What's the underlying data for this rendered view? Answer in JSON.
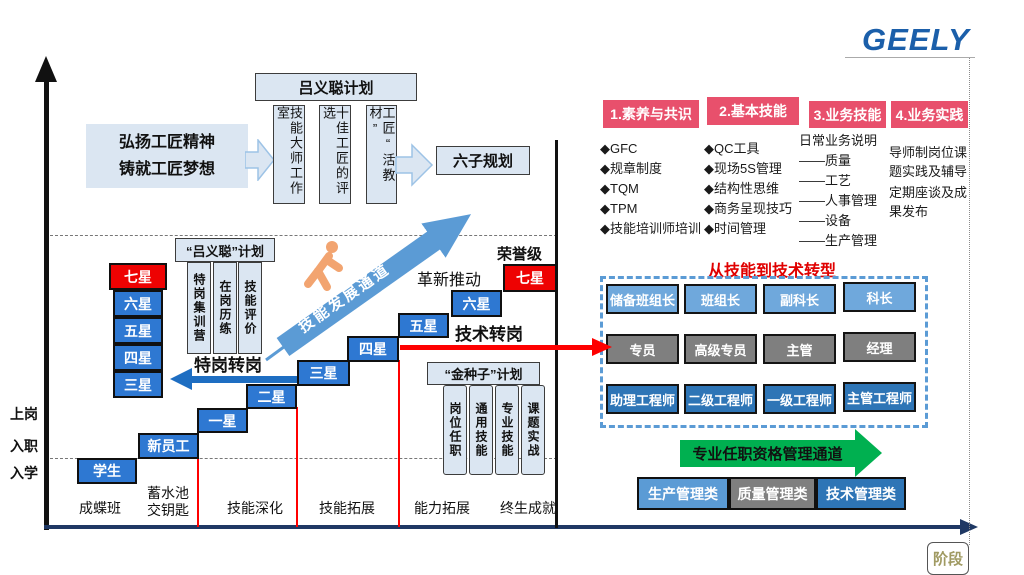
{
  "logo": {
    "text": "GEELY",
    "color": "#1b5faa"
  },
  "mission": {
    "line1": "弘扬工匠精神",
    "line2": "铸就工匠梦想"
  },
  "lvc_plan": {
    "title": "吕义聪计划",
    "columns": [
      "技能大师工作室",
      "十佳工匠的评选",
      "工匠“活教材”"
    ]
  },
  "six_plan": "六子规划",
  "quoted_plan": {
    "title": "“吕义聪”计划",
    "columns": [
      "特岗集训营",
      "在岗历练",
      "技能评价"
    ]
  },
  "gold_seed": {
    "title": "“金种子”计划",
    "columns": [
      "岗位任职",
      "通用技能",
      "专业技能",
      "课题实战"
    ]
  },
  "left_stars": {
    "top": "七星",
    "items": [
      "六星",
      "五星",
      "四星",
      "三星"
    ]
  },
  "staircase": [
    "学生",
    "新员工",
    "一星",
    "二星",
    "三星",
    "四星",
    "五星",
    "六星",
    "七星"
  ],
  "annotations": {
    "honor": "荣誉级",
    "innovation": "革新推动",
    "special_transfer": "特岗转岗",
    "tech_transfer": "技术转岗",
    "skill_channel": "技能发展通道",
    "stage": "阶段"
  },
  "axis": {
    "y_labels": [
      "上岗",
      "入职",
      "入学"
    ],
    "stages": [
      "成蝶班",
      "蓄水池\n交钥匙",
      "技能深化",
      "技能拓展",
      "能力拓展",
      "终生成就"
    ]
  },
  "categories": [
    {
      "title": "1.素养与共识",
      "items": [
        "◆GFC",
        "◆规章制度",
        "◆TQM",
        "◆TPM",
        "◆技能培训师培训"
      ]
    },
    {
      "title": "2.基本技能",
      "items": [
        "◆QC工具",
        "◆现场5S管理",
        "◆结构性思维",
        "◆商务呈现技巧",
        "◆时间管理"
      ]
    },
    {
      "title": "3.业务技能",
      "items": [
        "日常业务说明",
        "——质量",
        "——工艺",
        "——人事管理",
        "——设备",
        "——生产管理"
      ]
    },
    {
      "title": "4.业务实践",
      "items": [
        "导师制岗位课题实践及辅导",
        "定期座谈及成果发布"
      ]
    }
  ],
  "transition": {
    "title": "从技能到技术转型",
    "rows": [
      {
        "cells": [
          "储备班组长",
          "班组长",
          "副科长",
          "科长"
        ]
      },
      {
        "cells": [
          "专员",
          "高级专员",
          "主管",
          "经理"
        ]
      },
      {
        "cells": [
          "助理工程师",
          "二级工程师",
          "一级工程师",
          "主管工程师"
        ]
      }
    ]
  },
  "qualification": {
    "arrow": "专业任职资格管理通道",
    "tracks": [
      "生产管理类",
      "质量管理类",
      "技术管理类"
    ]
  },
  "colors": {
    "star_blue": "#2e78d2",
    "honor_red": "#ee0202",
    "pink_header": "#e8506c",
    "grid_light_blue": "#6fa8dc",
    "grid_gray": "#7f7f7f",
    "grid_blue": "#2e75b6",
    "channel_blue": "#5b9bd5",
    "green": "#00b050",
    "axis_navy": "#1f3864",
    "red_line": "#ff0000",
    "person_orange": "#f2a470"
  }
}
